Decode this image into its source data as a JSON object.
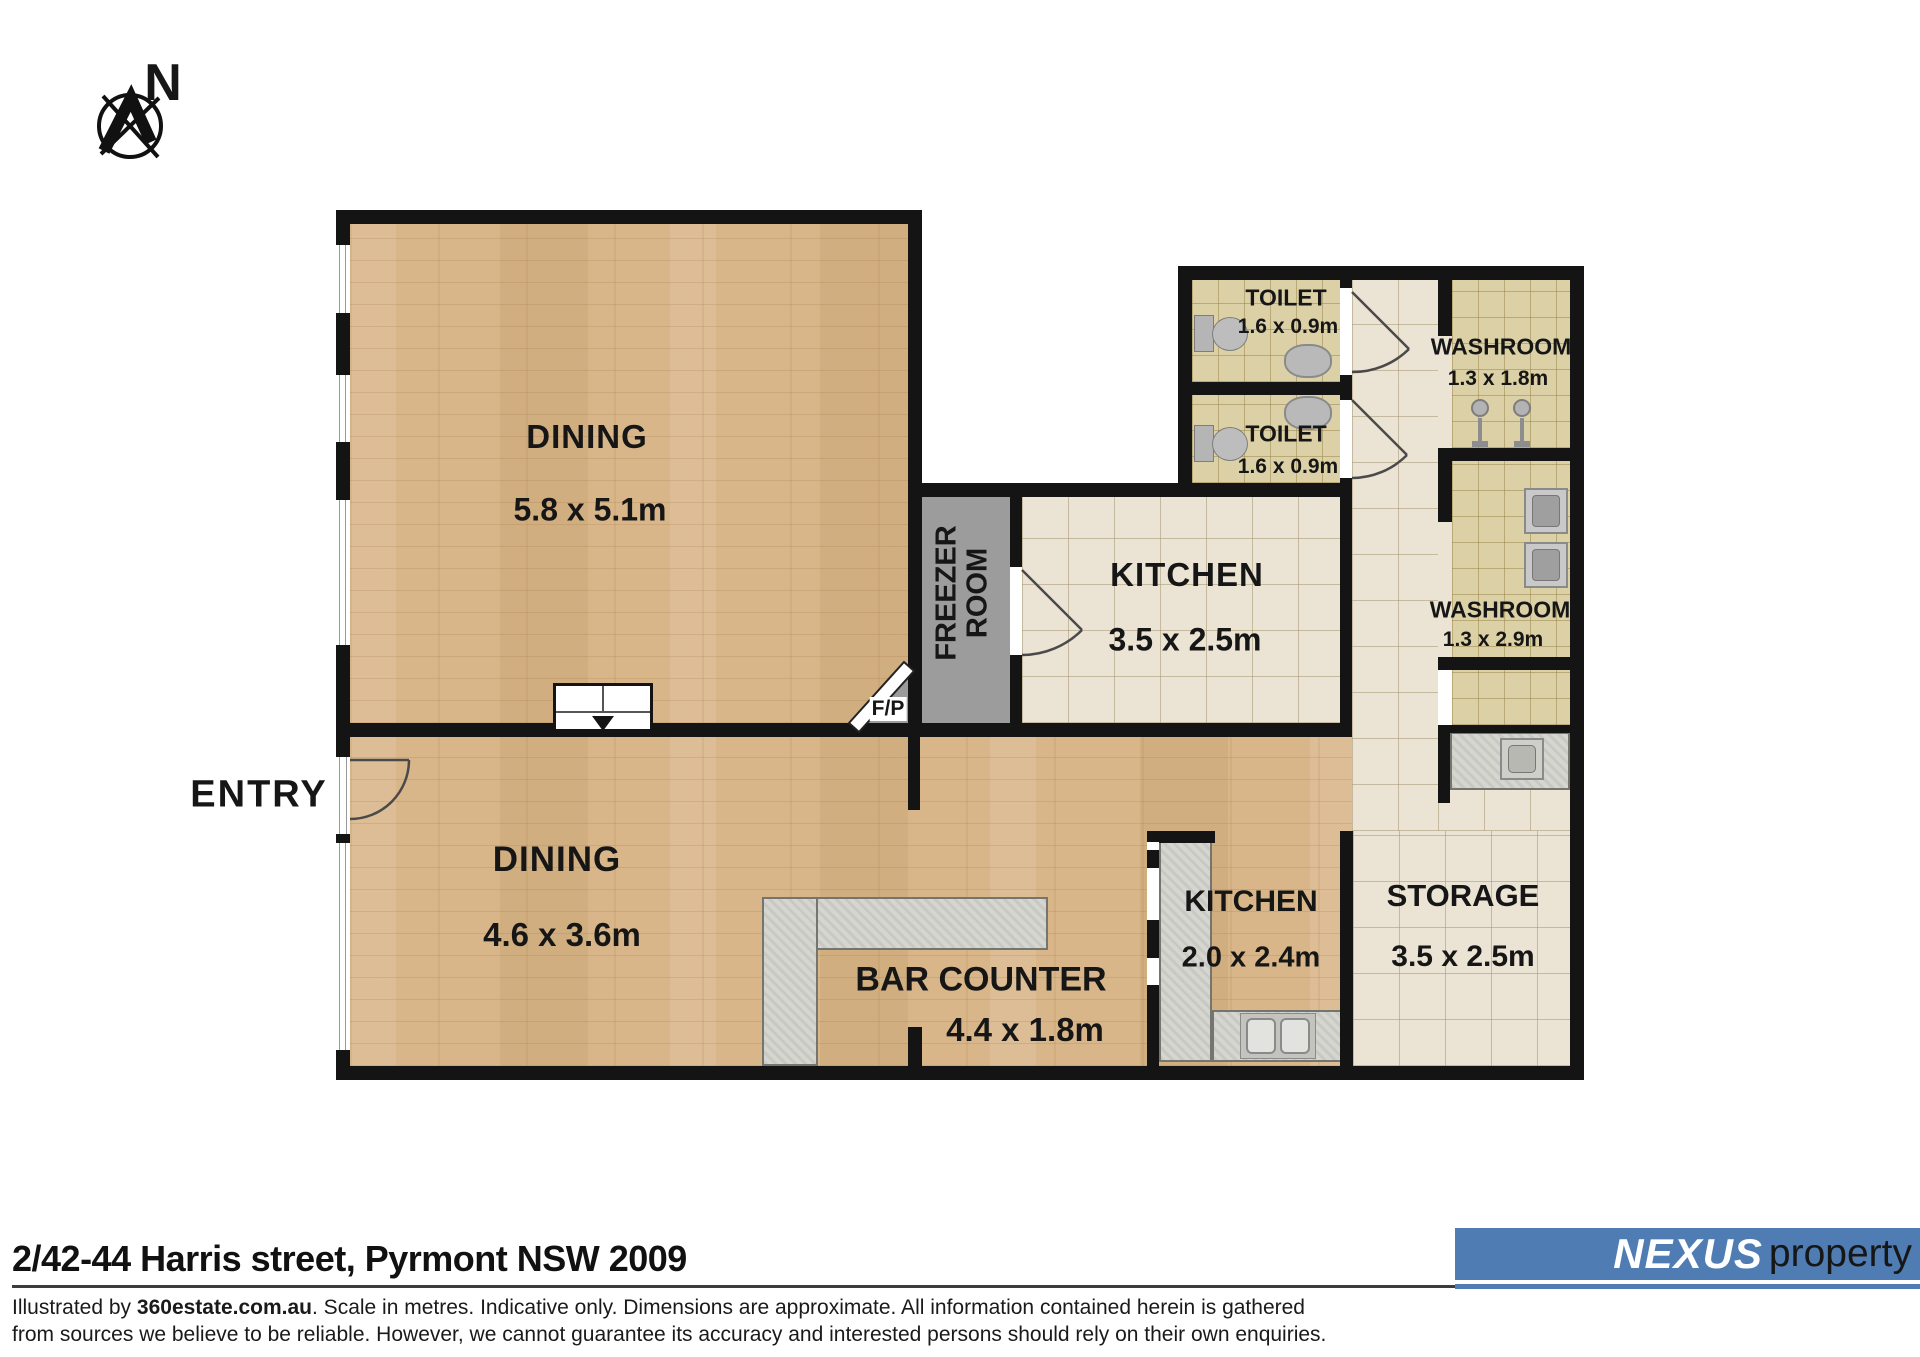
{
  "compass": {
    "north_label": "N"
  },
  "rooms": {
    "dining_upper": {
      "name": "DINING",
      "dims": "5.8 x 5.1m"
    },
    "dining_lower": {
      "name": "DINING",
      "dims": "4.6 x 3.6m"
    },
    "kitchen_upper": {
      "name": "KITCHEN",
      "dims": "3.5 x 2.5m"
    },
    "kitchen_lower": {
      "name": "KITCHEN",
      "dims": "2.0 x 2.4m"
    },
    "toilet_1": {
      "name": "TOILET",
      "dims": "1.6 x 0.9m"
    },
    "toilet_2": {
      "name": "TOILET",
      "dims": "1.6 x 0.9m"
    },
    "washroom_1": {
      "name": "WASHROOM",
      "dims": "1.3 x 1.8m"
    },
    "washroom_2": {
      "name": "WASHROOM",
      "dims": "1.3 x 2.9m"
    },
    "storage": {
      "name": "STORAGE",
      "dims": "3.5 x 2.5m"
    },
    "bar_counter": {
      "name": "BAR COUNTER",
      "dims": "4.4 x 1.8m"
    },
    "freezer": {
      "line1": "FREEZER",
      "line2": "ROOM"
    },
    "entry": {
      "name": "ENTRY"
    },
    "fireplace": {
      "label": "F/P"
    }
  },
  "footer": {
    "address": "2/42-44 Harris street, Pyrmont NSW 2009",
    "disclaimer": {
      "prefix": "Illustrated by ",
      "brand": "360estate.com.au",
      "line1_rest": ". Scale in metres. Indicative only. Dimensions are approximate. All information contained herein is gathered",
      "line2": "from sources we believe to be reliable. However, we cannot guarantee its accuracy and interested persons should rely on their own enquiries."
    },
    "logo": {
      "brand": "nexus",
      "suffix": "property",
      "accent_color": "#4f7db3"
    }
  }
}
